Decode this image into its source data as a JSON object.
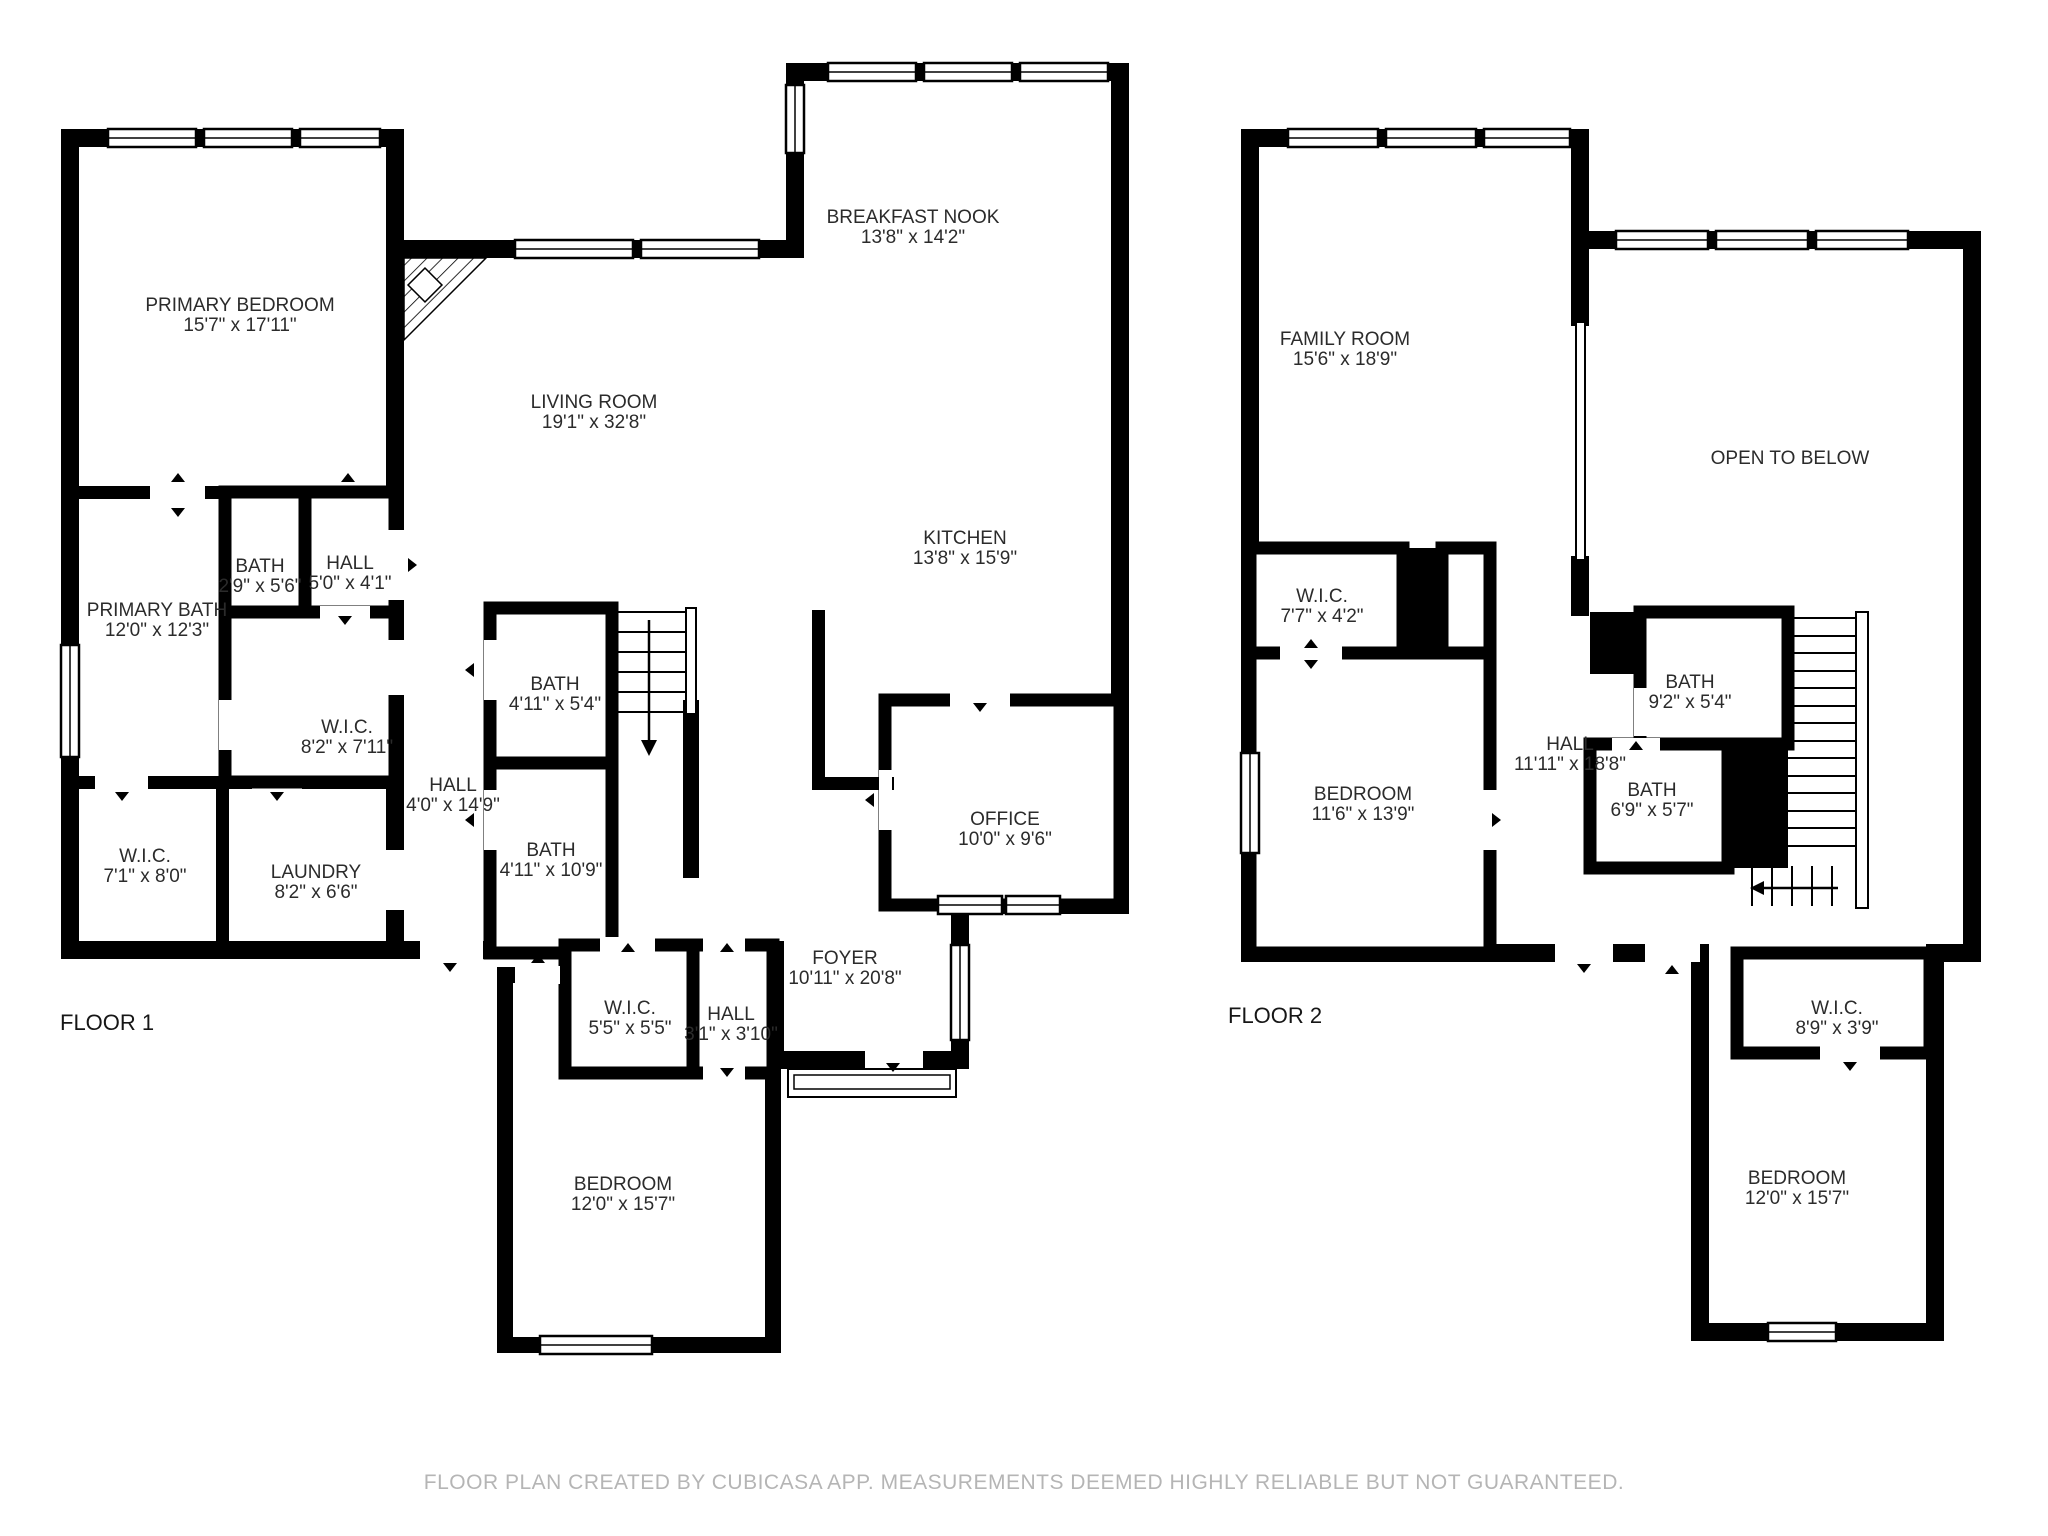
{
  "footer": {
    "text": "FLOOR PLAN CREATED BY CUBICASA APP. MEASUREMENTS DEEMED HIGHLY RELIABLE BUT NOT GUARANTEED."
  },
  "colors": {
    "walls": "#000000",
    "background": "#ffffff",
    "room_text": "#2b2b2b",
    "footer_text": "#b5b5b5"
  },
  "icons": {
    "door_swing_marker": "small black triangle",
    "stair_direction_arrow": "line with arrowhead",
    "fireplace": "corner hatched triangle",
    "window": "double-line white band",
    "railing": "thin double line"
  },
  "floors": [
    {
      "label": "FLOOR 1",
      "rooms": [
        {
          "name": "PRIMARY BEDROOM",
          "dims": "15'7\" x 17'11\""
        },
        {
          "name": "LIVING ROOM",
          "dims": "19'1\" x 32'8\""
        },
        {
          "name": "BREAKFAST NOOK",
          "dims": "13'8\" x 14'2\""
        },
        {
          "name": "KITCHEN",
          "dims": "13'8\" x 15'9\""
        },
        {
          "name": "BATH",
          "dims": "2'9\" x 5'6\""
        },
        {
          "name": "HALL",
          "dims": "5'0\" x 4'1\""
        },
        {
          "name": "PRIMARY BATH",
          "dims": "12'0\" x 12'3\""
        },
        {
          "name": "W.I.C.",
          "dims": "8'2\" x 7'11\""
        },
        {
          "name": "W.I.C.",
          "dims": "7'1\" x 8'0\""
        },
        {
          "name": "LAUNDRY",
          "dims": "8'2\" x 6'6\""
        },
        {
          "name": "HALL",
          "dims": "4'0\" x 14'9\""
        },
        {
          "name": "BATH",
          "dims": "4'11\" x 5'4\""
        },
        {
          "name": "BATH",
          "dims": "4'11\" x 10'9\""
        },
        {
          "name": "W.I.C.",
          "dims": "5'5\" x 5'5\""
        },
        {
          "name": "HALL",
          "dims": "3'1\" x 3'10\""
        },
        {
          "name": "BEDROOM",
          "dims": "12'0\" x 15'7\""
        },
        {
          "name": "FOYER",
          "dims": "10'11\" x 20'8\""
        },
        {
          "name": "OFFICE",
          "dims": "10'0\" x 9'6\""
        }
      ]
    },
    {
      "label": "FLOOR 2",
      "rooms": [
        {
          "name": "FAMILY ROOM",
          "dims": "15'6\" x 18'9\""
        },
        {
          "name": "OPEN TO BELOW",
          "dims": ""
        },
        {
          "name": "W.I.C.",
          "dims": "7'7\" x 4'2\""
        },
        {
          "name": "BEDROOM",
          "dims": "11'6\" x 13'9\""
        },
        {
          "name": "HALL",
          "dims": "11'11\" x 18'8\""
        },
        {
          "name": "BATH",
          "dims": "9'2\" x 5'4\""
        },
        {
          "name": "BATH",
          "dims": "6'9\" x 5'7\""
        },
        {
          "name": "W.I.C.",
          "dims": "8'9\" x 3'9\""
        },
        {
          "name": "BEDROOM",
          "dims": "12'0\" x 15'7\""
        }
      ]
    }
  ]
}
